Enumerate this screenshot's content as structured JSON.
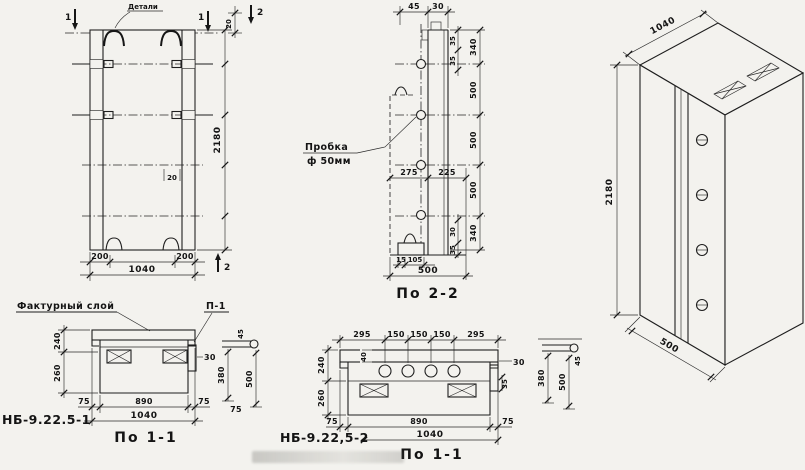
{
  "colors": {
    "paper": "#f3f2ee",
    "ink": "#161616"
  },
  "figures": {
    "elevation": {
      "label_detail": "Детали",
      "section_mark_1a": "1",
      "section_mark_1b": "1",
      "section_mark_2a": "2",
      "section_mark_2b": "2",
      "dim_gap_top": "20",
      "dim_pocket": "20",
      "dim_bottom": [
        "200",
        "200"
      ],
      "dim_width_total": "1040",
      "dim_height": "2180"
    },
    "section_2_2": {
      "label_plug_line1": "Пробка",
      "label_plug_line2": "ф 50мм",
      "dim_top": [
        "45",
        "30"
      ],
      "dim_neck": [
        "35",
        "35"
      ],
      "dim_heights": [
        "340",
        "500",
        "500",
        "500",
        "340"
      ],
      "dim_mid": [
        "275",
        "225"
      ],
      "dim_foot": [
        "30",
        "35"
      ],
      "dim_base": [
        "15",
        "105"
      ],
      "dim_depth_total": "500",
      "caption": "По 2-2"
    },
    "isometric": {
      "dim_width": "1040",
      "dim_height": "2180",
      "dim_depth": "500"
    },
    "plan_1": {
      "label_facing": "Фактурный слой",
      "label_p1": "П-1",
      "dim_left": [
        "240",
        "260"
      ],
      "dim_bar": "30",
      "dim_bottom": [
        "75",
        "890",
        "75"
      ],
      "dim_width_total": "1040",
      "product_mark": "НБ-9.22.5-1",
      "caption": "По 1-1",
      "detail_dims": [
        "45",
        "380",
        "500",
        "75"
      ]
    },
    "plan_2": {
      "dim_top": [
        "295",
        "150",
        "150",
        "150",
        "295"
      ],
      "dim_facing": "40",
      "dim_left": [
        "240",
        "260"
      ],
      "dim_bar": [
        "30",
        "35"
      ],
      "dim_bottom": [
        "75",
        "890",
        "75"
      ],
      "dim_width_total": "1040",
      "product_mark": "НБ-9.22,5-2",
      "caption": "По 1-1",
      "detail_dims": [
        "45",
        "380",
        "500"
      ]
    }
  }
}
